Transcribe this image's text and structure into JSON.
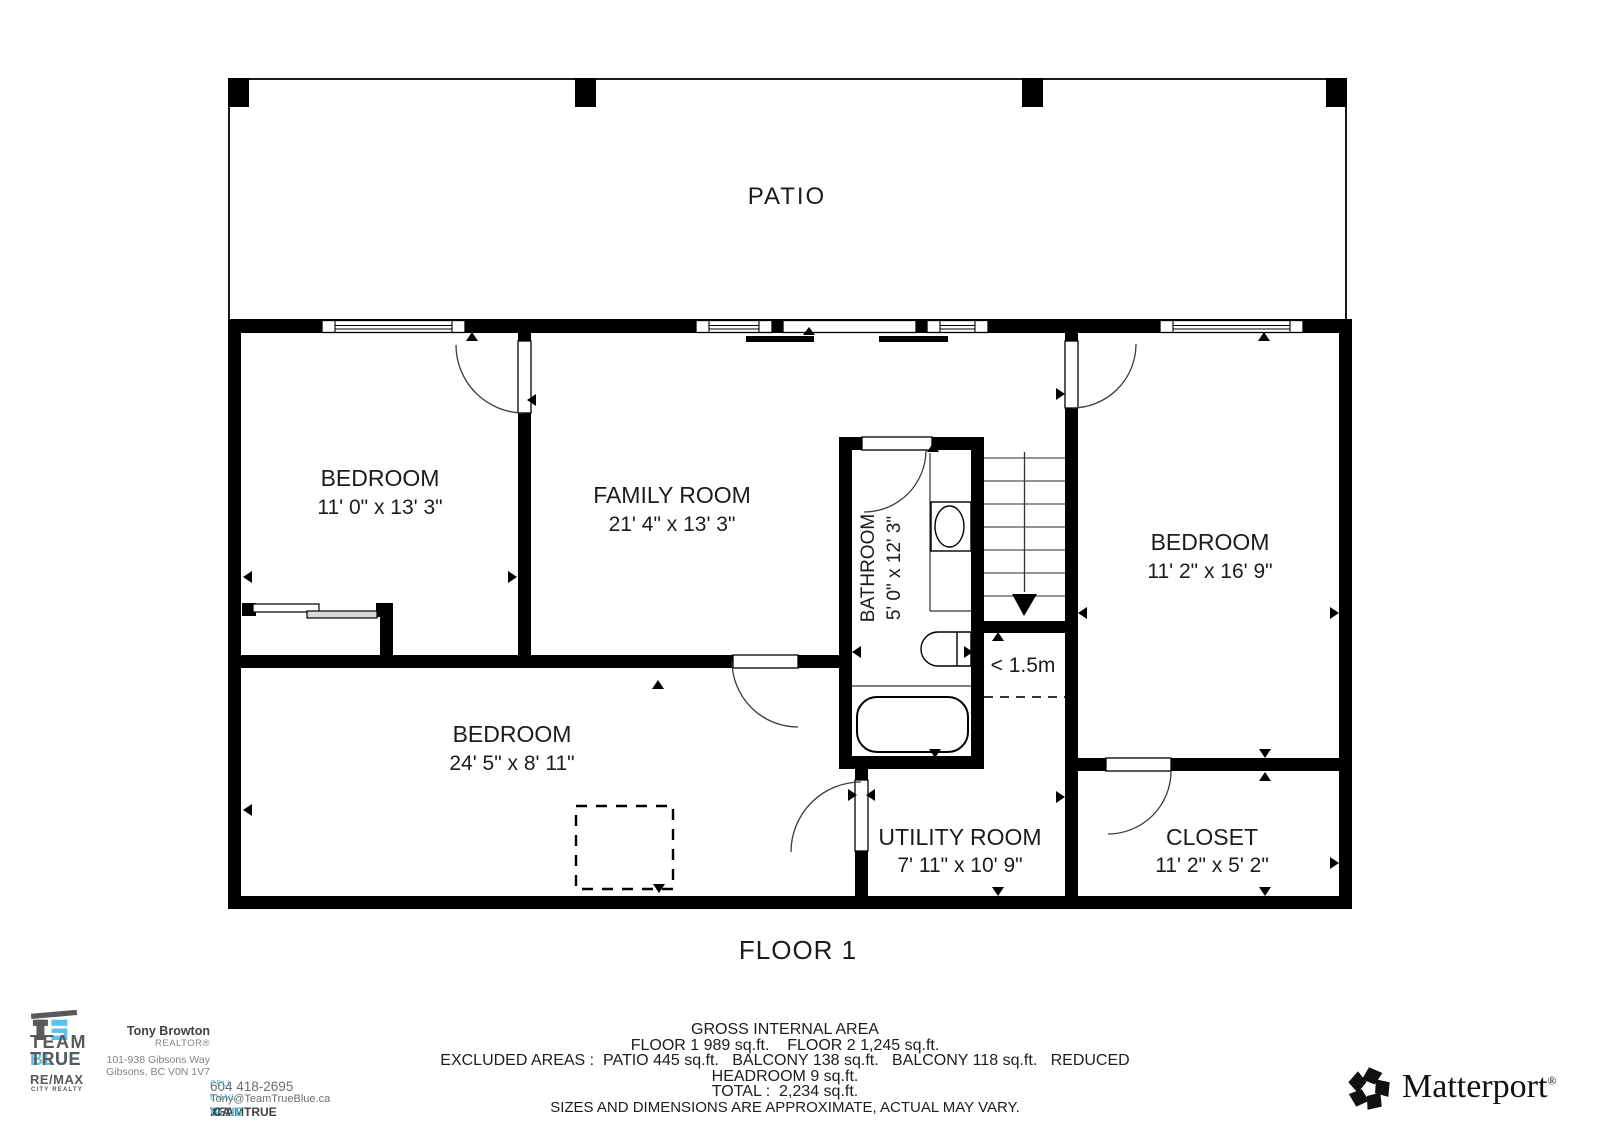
{
  "plan": {
    "floor_title": "FLOOR 1",
    "patio_label": "PATIO",
    "reduced_headroom_label": "< 1.5m",
    "rooms": [
      {
        "name": "BEDROOM",
        "dims": "11' 0\" x 13' 3\""
      },
      {
        "name": "FAMILY ROOM",
        "dims": "21' 4\" x 13' 3\""
      },
      {
        "name": "BATHROOM",
        "dims": "5' 0\" x 12' 3\""
      },
      {
        "name": "BEDROOM",
        "dims": "11' 2\" x 16' 9\""
      },
      {
        "name": "BEDROOM",
        "dims": "24' 5\" x 8' 11\""
      },
      {
        "name": "UTILITY ROOM",
        "dims": "7' 11\" x 10' 9\""
      },
      {
        "name": "CLOSET",
        "dims": "11' 2\" x 5' 2\""
      }
    ]
  },
  "area_summary": {
    "title": "GROSS INTERNAL AREA",
    "floors_line": "FLOOR 1 989 sq.ft.    FLOOR 2 1,245 sq.ft.",
    "excluded_line": "EXCLUDED AREAS :  PATIO 445 sq.ft.   BALCONY 138 sq.ft.   BALCONY 118 sq.ft.   REDUCED",
    "excluded_line2": "HEADROOM 9 sq.ft.",
    "total_line": "TOTAL :  2,234 sq.ft.",
    "disclaimer": "SIZES AND DIMENSIONS ARE APPROXIMATE, ACTUAL MAY VARY."
  },
  "agent": {
    "team_word": "TEAM",
    "true_word": "TRUE",
    "blue_word": "BLUE",
    "brokerage": "RE/MAX",
    "brokerage_sub": "CITY REALTY",
    "name": "Tony Browton",
    "title": "REALTOR®",
    "address_line1": "101-938 Gibsons Way",
    "address_line2": "Gibsons, BC V0N 1V7",
    "cell_label": "CELL",
    "cell_number": "604 418-2695",
    "email_label": "EMAIL",
    "email": "Tony@TeamTrueBlue.ca",
    "site_part1": "TEAMTRUE",
    "site_part2": "BLUE",
    "site_part3": ".CA",
    "colors": {
      "dark_gray": "#58595b",
      "light_blue": "#5bc2e7",
      "text_gray": "#808285"
    }
  },
  "branding": {
    "matterport_word": "Matterport",
    "registered_mark": "®"
  }
}
